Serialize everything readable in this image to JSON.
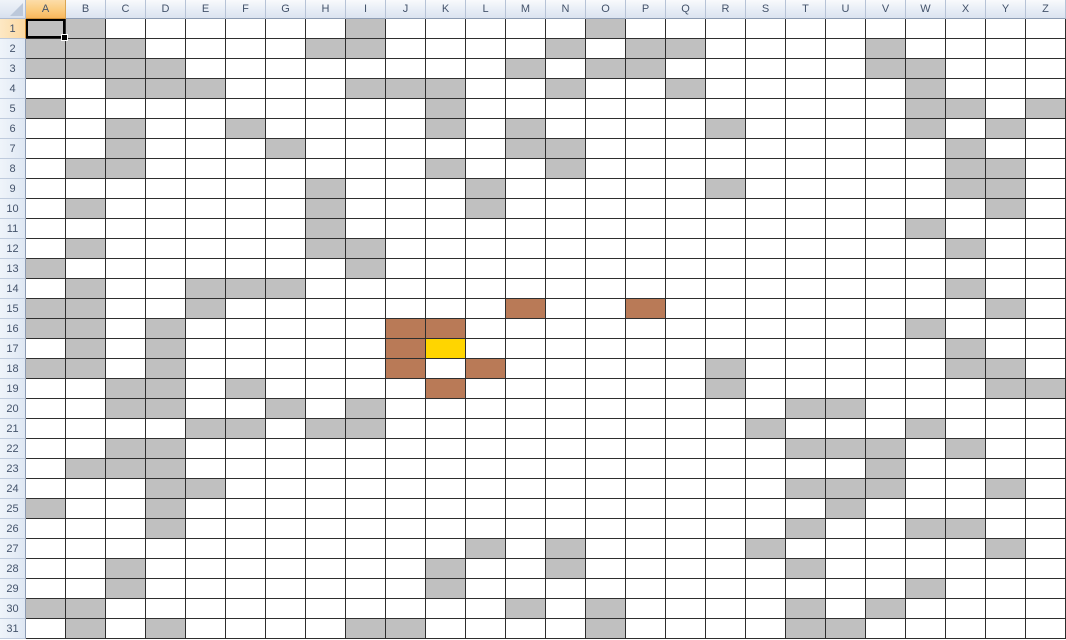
{
  "grid": {
    "columns": [
      "A",
      "B",
      "C",
      "D",
      "E",
      "F",
      "G",
      "H",
      "I",
      "J",
      "K",
      "L",
      "M",
      "N",
      "O",
      "P",
      "Q",
      "R",
      "S",
      "T",
      "U",
      "V",
      "W",
      "X",
      "Y",
      "Z"
    ],
    "rows": [
      "1",
      "2",
      "3",
      "4",
      "5",
      "6",
      "7",
      "8",
      "9",
      "10",
      "11",
      "12",
      "13",
      "14",
      "15",
      "16",
      "17",
      "18",
      "19",
      "20",
      "21",
      "22",
      "23",
      "24",
      "25",
      "26",
      "27",
      "28",
      "29",
      "30",
      "31"
    ],
    "selection": {
      "active_cell": "A1",
      "selected_column": "A",
      "selected_row": "1"
    },
    "fills": {
      "gray": [
        "A1",
        "B1",
        "I1",
        "O1",
        "A2",
        "B2",
        "C2",
        "H2",
        "I2",
        "N2",
        "P2",
        "Q2",
        "V2",
        "A3",
        "B3",
        "C3",
        "D3",
        "M3",
        "O3",
        "P3",
        "V3",
        "W3",
        "C4",
        "D4",
        "E4",
        "I4",
        "J4",
        "K4",
        "N4",
        "Q4",
        "W4",
        "A5",
        "K5",
        "W5",
        "X5",
        "Z5",
        "C6",
        "F6",
        "K6",
        "M6",
        "R6",
        "W6",
        "Y6",
        "C7",
        "G7",
        "M7",
        "N7",
        "X7",
        "B8",
        "C8",
        "K8",
        "N8",
        "X8",
        "Y8",
        "H9",
        "L9",
        "R9",
        "X9",
        "Y9",
        "B10",
        "H10",
        "L10",
        "Y10",
        "H11",
        "W11",
        "B12",
        "H12",
        "I12",
        "X12",
        "A13",
        "I13",
        "B14",
        "E14",
        "F14",
        "G14",
        "X14",
        "A15",
        "B15",
        "E15",
        "Y15",
        "A16",
        "B16",
        "D16",
        "W16",
        "B17",
        "D17",
        "X17",
        "A18",
        "B18",
        "D18",
        "R18",
        "X18",
        "Y18",
        "C19",
        "D19",
        "F19",
        "R19",
        "Y19",
        "Z19",
        "C20",
        "D20",
        "G20",
        "I20",
        "T20",
        "U20",
        "E21",
        "F21",
        "H21",
        "I21",
        "S21",
        "W21",
        "C22",
        "D22",
        "T22",
        "U22",
        "V22",
        "X22",
        "B23",
        "C23",
        "D23",
        "V23",
        "D24",
        "E24",
        "T24",
        "U24",
        "V24",
        "Y24",
        "A25",
        "D25",
        "U25",
        "D26",
        "T26",
        "W26",
        "X26",
        "L27",
        "N27",
        "S27",
        "Y27",
        "C28",
        "K28",
        "N28",
        "T28",
        "C29",
        "K29",
        "W29",
        "A30",
        "B30",
        "M30",
        "O30",
        "T30",
        "V30",
        "B31",
        "D31",
        "I31",
        "J31",
        "O31",
        "T31",
        "U31"
      ],
      "brown": [
        "M15",
        "P15",
        "J16",
        "K16",
        "J17",
        "J18",
        "L18",
        "K19"
      ],
      "yellow": [
        "K17"
      ]
    },
    "colors": {
      "gray": "#c0c0c0",
      "brown": "#b97a57",
      "yellow": "#ffd500",
      "grid_line": "#2e2e2e",
      "header_selected": "#f8b75d",
      "header_text": "#44536b"
    }
  }
}
